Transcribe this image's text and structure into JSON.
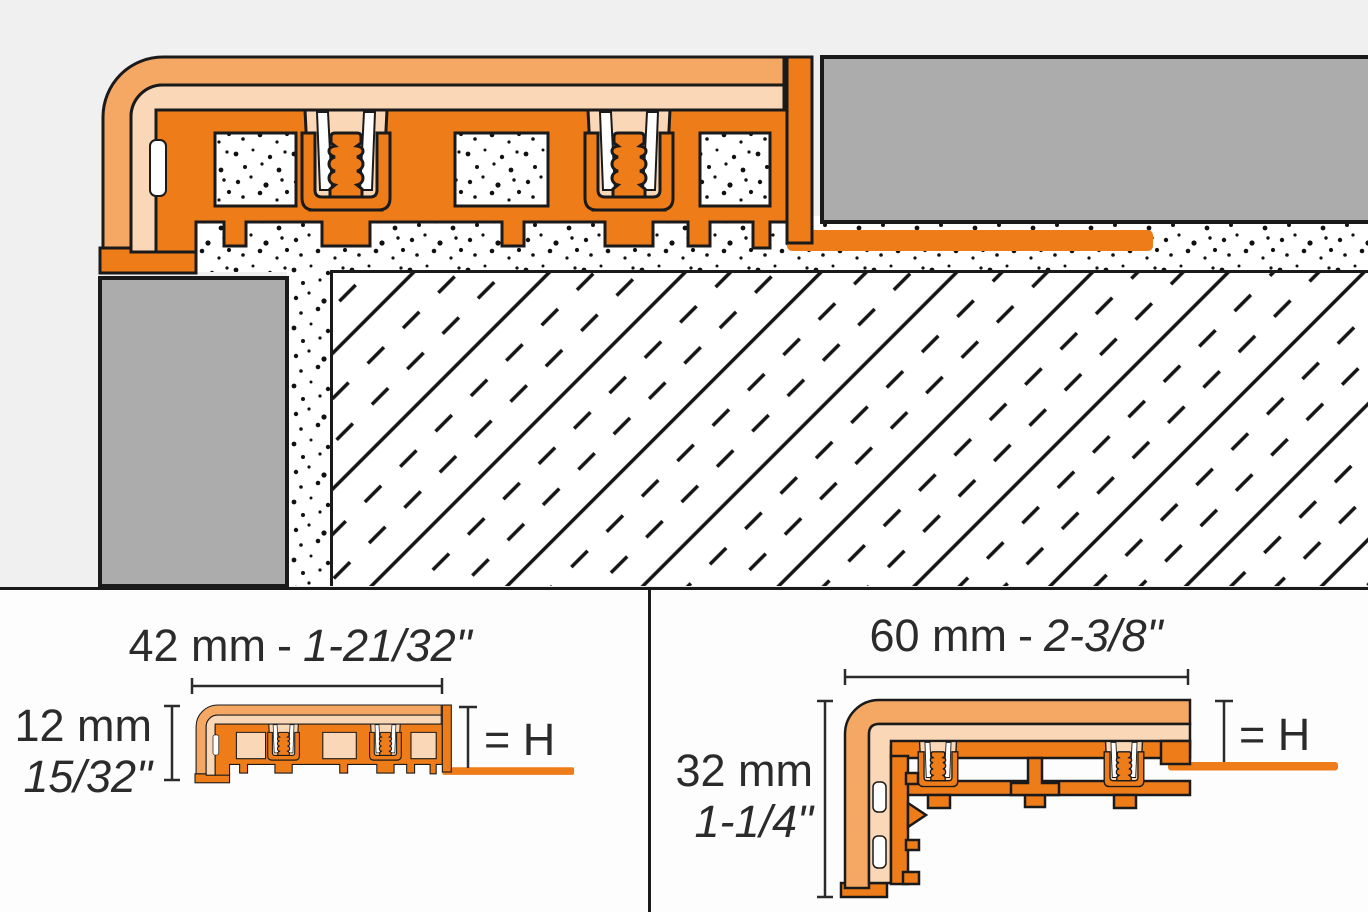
{
  "panels": {
    "left": {
      "width_metric": "42 mm",
      "separator": "-",
      "width_imperial": "1-21/32\"",
      "height_metric": "12 mm",
      "height_imperial": "15/32\"",
      "height_reference": "= H"
    },
    "right": {
      "width_metric": "60 mm",
      "separator": "-",
      "width_imperial": "2-3/8\"",
      "height_metric": "32 mm",
      "height_imperial": "1-1/4\"",
      "height_reference": "= H"
    }
  },
  "colors": {
    "profile_orange": "#EE7C19",
    "profile_band_orange": "#F5A863",
    "profile_insert_peach": "#FAD8B7",
    "tile_gray": "#ACACAC",
    "outline": "#1A1A1A",
    "upper_background": "#F0F0F0",
    "lower_background": "#FDFDFD",
    "dimension_text": "#2B2B2B"
  }
}
